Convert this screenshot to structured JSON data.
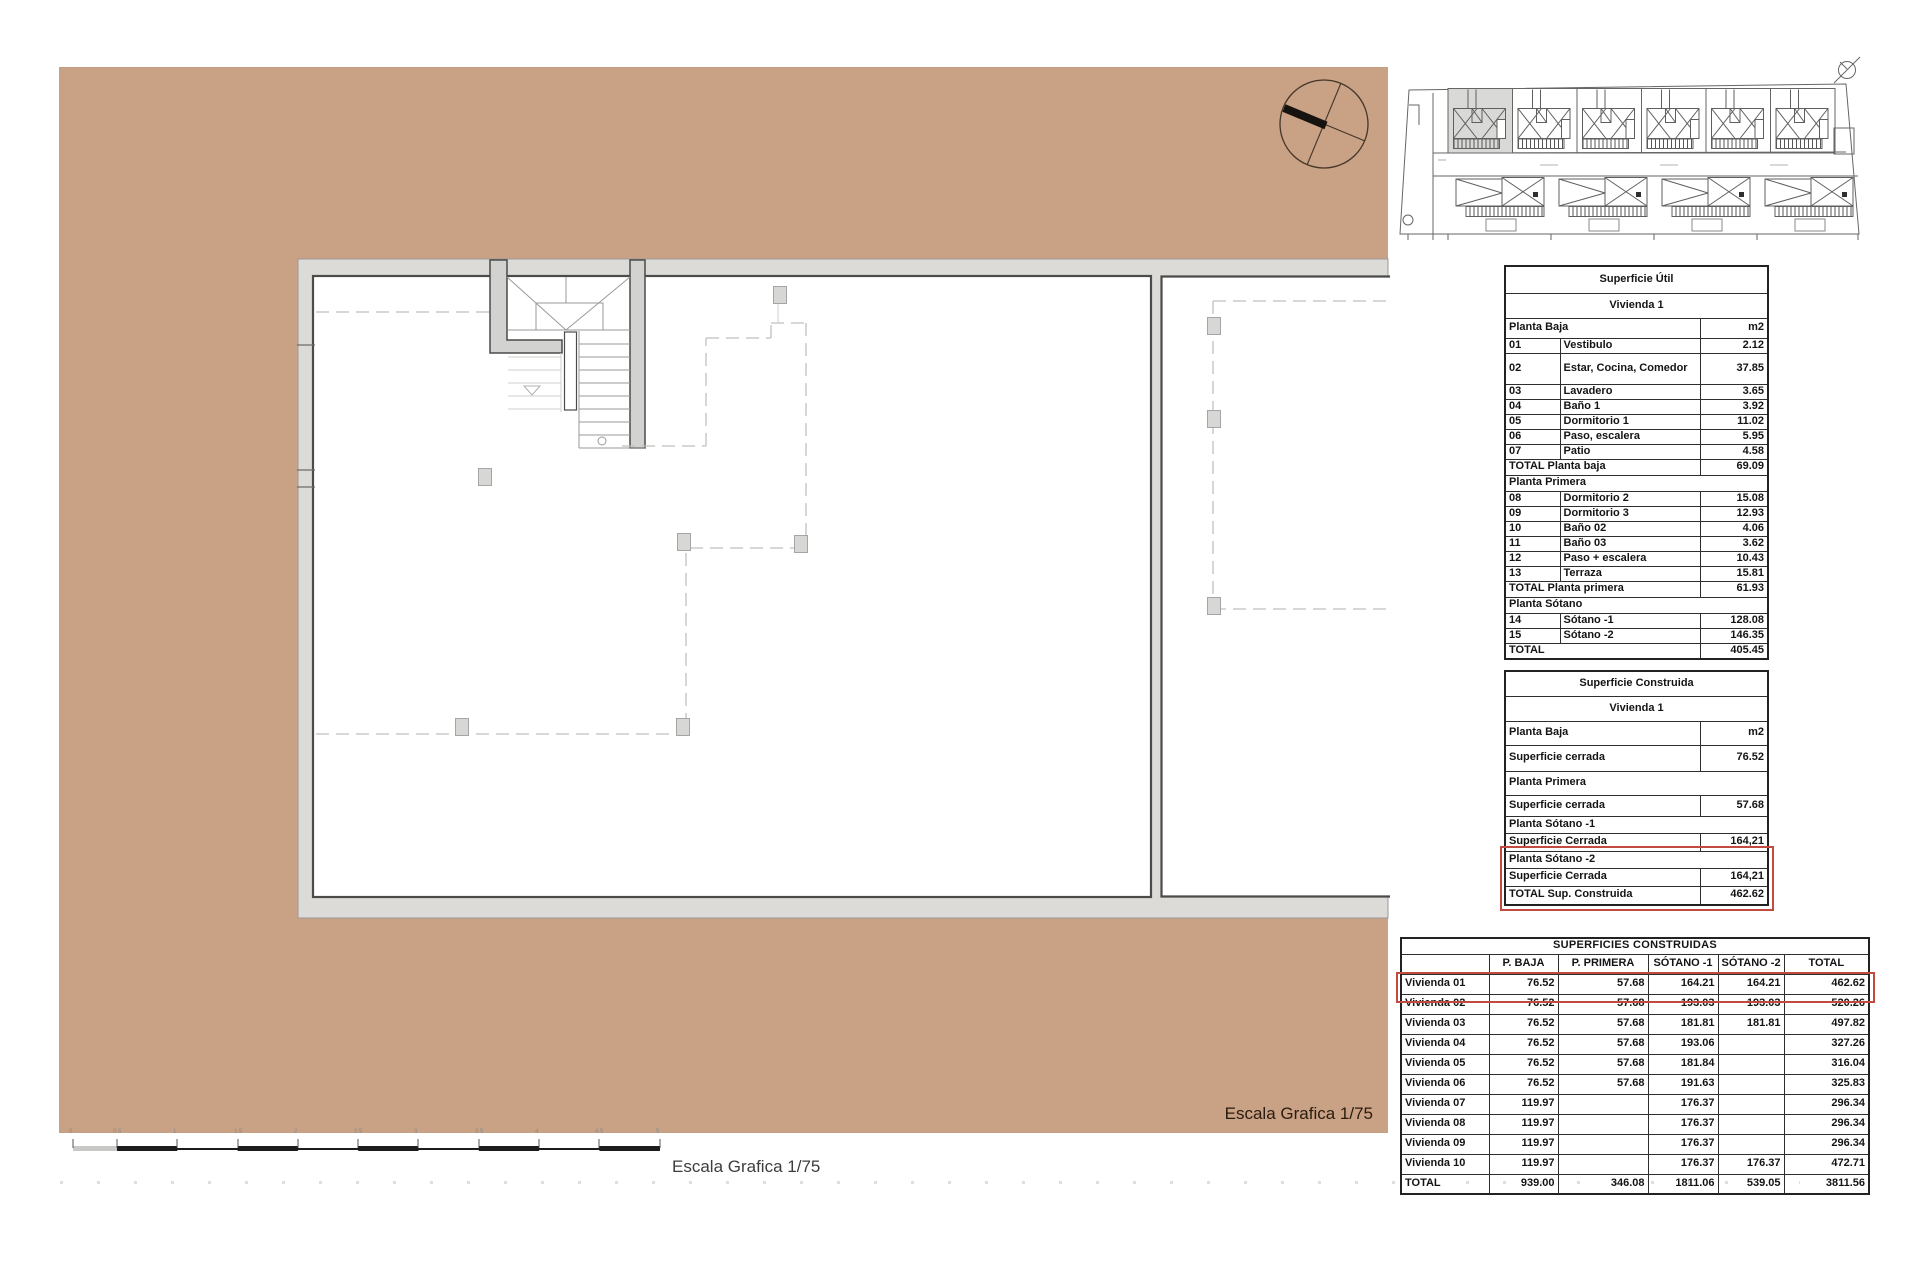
{
  "captions": {
    "escala_plan": "Escala Grafica 1/75",
    "escala_bottom": "Escala Grafica 1/75"
  },
  "scale_bar": {
    "labels": [
      "0",
      "0.5",
      "1",
      "1.5",
      "2",
      "2.5",
      "3",
      "3.5",
      "4",
      "4.5",
      "5"
    ]
  },
  "colors": {
    "plot_tan": "#c9a184",
    "band_gray": "#dcdbd8",
    "wall_dark": "#4b4b49",
    "accent_red": "#c24a3e"
  },
  "tables": {
    "superficie_util": {
      "title": "Superficie Útil",
      "subtitle": "Vivienda 1",
      "rows": [
        {
          "type": "sec2",
          "label": "Planta Baja",
          "value": "m2"
        },
        {
          "type": "item",
          "num": "01",
          "label": "Vestibulo",
          "value": "2.12"
        },
        {
          "type": "item tall",
          "num": "02",
          "label": "Estar, Cocina, Comedor",
          "value": "37.85"
        },
        {
          "type": "item",
          "num": "03",
          "label": "Lavadero",
          "value": "3.65"
        },
        {
          "type": "item",
          "num": "04",
          "label": "Baño 1",
          "value": "3.92"
        },
        {
          "type": "item",
          "num": "05",
          "label": "Dormitorio 1",
          "value": "11.02"
        },
        {
          "type": "item",
          "num": "06",
          "label": "Paso, escalera",
          "value": "5.95"
        },
        {
          "type": "item",
          "num": "07",
          "label": "Patio",
          "value": "4.58"
        },
        {
          "type": "total",
          "label": "TOTAL Planta baja",
          "value": "69.09"
        },
        {
          "type": "sec",
          "label": "Planta Primera",
          "value": ""
        },
        {
          "type": "item",
          "num": "08",
          "label": "Dormitorio 2",
          "value": "15.08"
        },
        {
          "type": "item",
          "num": "09",
          "label": "Dormitorio 3",
          "value": "12.93"
        },
        {
          "type": "item",
          "num": "10",
          "label": "Baño 02",
          "value": "4.06"
        },
        {
          "type": "item",
          "num": "11",
          "label": "Baño 03",
          "value": "3.62"
        },
        {
          "type": "item",
          "num": "12",
          "label": "Paso + escalera",
          "value": "10.43"
        },
        {
          "type": "item",
          "num": "13",
          "label": "Terraza",
          "value": "15.81"
        },
        {
          "type": "total",
          "label": "TOTAL Planta primera",
          "value": "61.93"
        },
        {
          "type": "sec",
          "label": "Planta Sótano",
          "value": ""
        },
        {
          "type": "item",
          "num": "14",
          "label": "Sótano -1",
          "value": "128.08"
        },
        {
          "type": "item",
          "num": "15",
          "label": "Sótano -2",
          "value": "146.35"
        },
        {
          "type": "total",
          "label": "TOTAL",
          "value": "405.45"
        }
      ]
    },
    "superficie_construida": {
      "title": "Superficie Construida",
      "subtitle": "Vivienda 1",
      "rows": [
        {
          "type": "sec2",
          "label": "Planta Baja",
          "value": "m2"
        },
        {
          "type": "item2",
          "label": "Superficie cerrada",
          "value": "76.52"
        },
        {
          "type": "sec",
          "label": "Planta Primera",
          "value": ""
        },
        {
          "type": "item2",
          "label": "Superficie cerrada",
          "value": "57.68"
        },
        {
          "type": "sec",
          "label": "Planta Sótano -1",
          "value": ""
        },
        {
          "type": "item2",
          "label": "Superficie Cerrada",
          "value": "164,21"
        },
        {
          "type": "sec",
          "label": "Planta Sótano -2",
          "value": ""
        },
        {
          "type": "item2",
          "label": "Superficie Cerrada",
          "value": "164,21"
        },
        {
          "type": "total",
          "label": "TOTAL Sup. Construida",
          "value": "462.62"
        }
      ]
    },
    "superficies_construidas": {
      "title": "SUPERFICIES CONSTRUIDAS",
      "headers": [
        "",
        "P. BAJA",
        "P. PRIMERA",
        "SÓTANO -1",
        "SÓTANO -2",
        "TOTAL"
      ],
      "rows": [
        {
          "name": "Vivienda 01",
          "values": [
            "76.52",
            "57.68",
            "164.21",
            "164.21",
            "462.62"
          ],
          "highlight": true
        },
        {
          "name": "Vivienda 02",
          "values": [
            "76.52",
            "57.68",
            "193.03",
            "193.03",
            "520.26"
          ]
        },
        {
          "name": "Vivienda 03",
          "values": [
            "76.52",
            "57.68",
            "181.81",
            "181.81",
            "497.82"
          ]
        },
        {
          "name": "Vivienda 04",
          "values": [
            "76.52",
            "57.68",
            "193.06",
            "",
            "327.26"
          ]
        },
        {
          "name": "Vivienda 05",
          "values": [
            "76.52",
            "57.68",
            "181.84",
            "",
            "316.04"
          ]
        },
        {
          "name": "Vivienda 06",
          "values": [
            "76.52",
            "57.68",
            "191.63",
            "",
            "325.83"
          ]
        },
        {
          "name": "Vivienda 07",
          "values": [
            "119.97",
            "",
            "176.37",
            "",
            "296.34"
          ]
        },
        {
          "name": "Vivienda 08",
          "values": [
            "119.97",
            "",
            "176.37",
            "",
            "296.34"
          ]
        },
        {
          "name": "Vivienda 09",
          "values": [
            "119.97",
            "",
            "176.37",
            "",
            "296.34"
          ]
        },
        {
          "name": "Vivienda 10",
          "values": [
            "119.97",
            "",
            "176.37",
            "176.37",
            "472.71"
          ]
        },
        {
          "name": "TOTAL",
          "values": [
            "939.00",
            "346.08",
            "1811.06",
            "539.05",
            "3811.56"
          ],
          "is_total": true
        }
      ]
    }
  }
}
